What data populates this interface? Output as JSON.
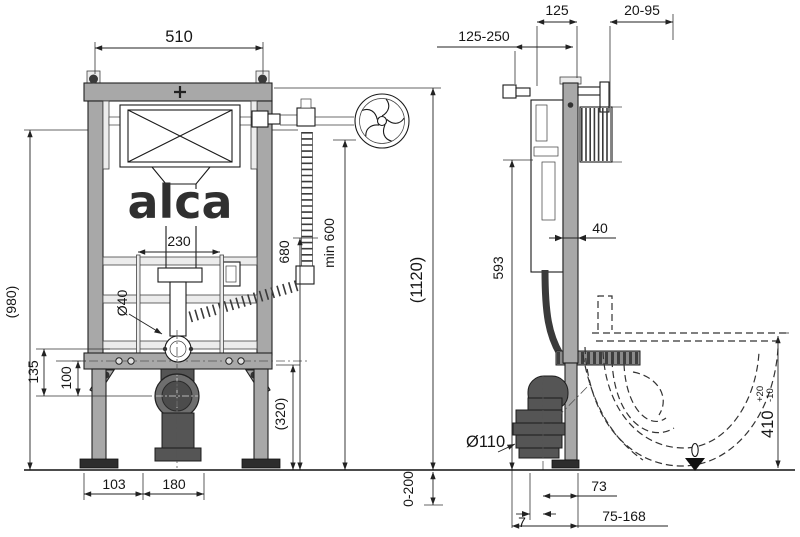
{
  "drawing_type": "installation frame for wall-hung WC - dimensioned technical drawing, front and side view",
  "brand_logo": "alca",
  "colors": {
    "background": "#ffffff",
    "frame_steel": "#a8a8a8",
    "dark_fitting": "#555555",
    "foot_plate": "#2d2d2d",
    "line": "#1a1a1a"
  },
  "front": {
    "width": "510",
    "plate_width": "230",
    "pipe_dia": "Ø40",
    "inlet_height": "680",
    "supply_min": "min 600",
    "overall_height": "(1120)",
    "frame_height": "(980)",
    "offset_135": "135",
    "offset_100": "100",
    "lower_height": "(320)",
    "foot_offset": "103",
    "drain_offset": "180",
    "foot_adjust": "0-200"
  },
  "side": {
    "depth": "125",
    "wall_range": "20-95",
    "supply_range": "125-250",
    "profile_depth": "40",
    "cistern_height": "593",
    "drain_dia": "Ø110",
    "bowl_height": "410",
    "bowl_tol_plus": "+20",
    "bowl_tol_minus": "-10",
    "drain_front": "73",
    "drain_gap": "7",
    "outlet_range": "75-168"
  }
}
